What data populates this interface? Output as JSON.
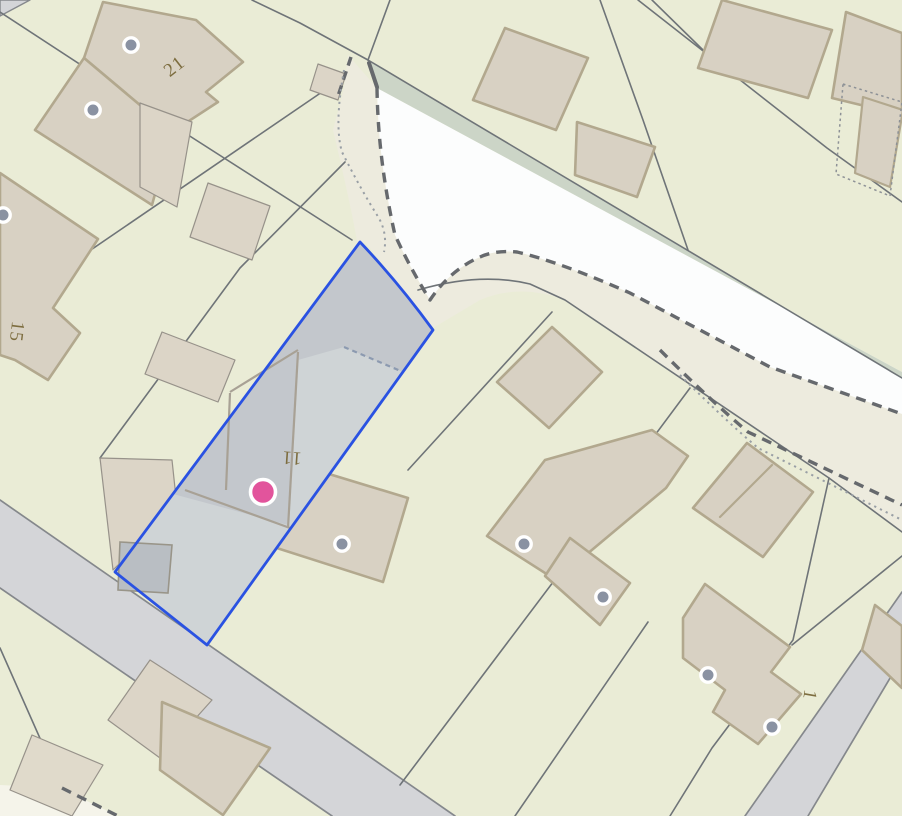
{
  "map": {
    "canvas": {
      "width": 902,
      "height": 816,
      "background": "#eaecd6"
    },
    "palette": {
      "parcel_bg": "#eaecd6",
      "boundary_line": "#6f7478",
      "building_fill": "#d8d1c3",
      "building_border": "#b2a88e",
      "building_thin_border": "#97928a",
      "building_light_fill": "#dcd5c7",
      "road_fill": "#d4d5d8",
      "road_edge": "#85888c",
      "track_white": "#fcfdfd",
      "track_margin": "#edebde",
      "verge_green": "#ccd5c7",
      "bold_dash": "#66696d",
      "fine_dot": "#999fa5",
      "selected_outline": "#2a52e2",
      "selected_fill_light": "#cfd4d6",
      "selected_fill_dark": "#c3c7cc",
      "selected_outbuilding": "#b9bec3",
      "selected_inner_line": "#a8a195",
      "selected_inner_dash": "#8c9ab0",
      "address_dot": "#8a92a2",
      "marker_pink": "#e2549c",
      "label_color": "#7d6d3f"
    },
    "shapes": [
      {
        "name": "road-corner-top-left",
        "kind": "polygon",
        "points": "0,0 30,0 0,16",
        "fill": "#d4d5d8",
        "stroke": "#85888c",
        "width": 1.4
      },
      {
        "name": "track-margin",
        "kind": "path",
        "d": "M348,55 L377,88 Q378,160 395,235 Q410,268 430,300 Q450,270 480,257 Q495,250 517,252 Q560,262 630,293 L770,367 L902,414 L902,532 L830,478 L565,300 Q520,283 480,300 L433,328 L365,242 L358,247 Q352,210 333,130 L344,88 Z",
        "fill": "#edebde"
      },
      {
        "name": "track-white-surface",
        "kind": "path",
        "d": "M377,88 L902,372 L902,414 L770,367 L630,293 Q560,262 517,252 Q495,250 480,257 Q450,270 430,300 Q410,268 395,235 Q378,160 377,88 Z",
        "fill": "#fcfdfd"
      },
      {
        "name": "roadside-verge",
        "kind": "path",
        "d": "M368,60 L902,378 L902,372 L377,88 Z",
        "fill": "#ccd5c7"
      },
      {
        "name": "verge-end-cap",
        "kind": "line",
        "x1": 369,
        "y1": 63,
        "x2": 377,
        "y2": 87,
        "stroke": "#66696d",
        "width": 4
      },
      {
        "name": "road-bottom-left",
        "kind": "polygon",
        "points": "0,500 455,816 332,816 0,588",
        "fill": "#d4d5d8"
      },
      {
        "name": "road-bottom-left-edge-ne",
        "kind": "line",
        "x1": 0,
        "y1": 500,
        "x2": 455,
        "y2": 816,
        "stroke": "#85888c",
        "width": 1.7
      },
      {
        "name": "road-bottom-left-edge-sw",
        "kind": "line",
        "x1": 0,
        "y1": 588,
        "x2": 332,
        "y2": 816,
        "stroke": "#85888c",
        "width": 1.7
      },
      {
        "name": "road-bottom-right",
        "kind": "polygon",
        "points": "902,592 902,658 808,816 745,816",
        "fill": "#d4d5d8"
      },
      {
        "name": "road-bottom-right-edge-ne",
        "kind": "line",
        "x1": 902,
        "y1": 592,
        "x2": 745,
        "y2": 816,
        "stroke": "#85888c",
        "width": 1.7
      },
      {
        "name": "road-bottom-right-edge-sw",
        "kind": "line",
        "x1": 902,
        "y1": 658,
        "x2": 808,
        "y2": 816,
        "stroke": "#85888c",
        "width": 1.7
      },
      {
        "name": "footpath-patch-bottom-left",
        "kind": "polygon",
        "points": "0,785 60,788 118,816 0,816",
        "fill": "#f5f4ea"
      },
      {
        "name": "parcel-line",
        "kind": "path",
        "d": "M0,12 L185,133 L352,240",
        "stroke": "#6f7478",
        "width": 1.6
      },
      {
        "name": "parcel-line",
        "kind": "path",
        "d": "M252,0 L300,23 L368,60",
        "stroke": "#6f7478",
        "width": 1.6
      },
      {
        "name": "parcel-line",
        "kind": "path",
        "d": "M390,0 L368,60",
        "stroke": "#6f7478",
        "width": 1.6
      },
      {
        "name": "parcel-line",
        "kind": "path",
        "d": "M368,60 L902,378",
        "stroke": "#6f7478",
        "width": 1.6
      },
      {
        "name": "parcel-line",
        "kind": "path",
        "d": "M418,290 Q480,272 530,284 L565,300 L829,478 L902,532",
        "stroke": "#6f7478",
        "width": 1.6
      },
      {
        "name": "parcel-line",
        "kind": "path",
        "d": "M322,92 L0,312",
        "stroke": "#6f7478",
        "width": 1.6
      },
      {
        "name": "parcel-line",
        "kind": "path",
        "d": "M345,162 L240,268 L100,458",
        "stroke": "#6f7478",
        "width": 1.6
      },
      {
        "name": "parcel-line",
        "kind": "path",
        "d": "M600,0 L643,120 L688,250",
        "stroke": "#6f7478",
        "width": 1.6
      },
      {
        "name": "parcel-line",
        "kind": "path",
        "d": "M638,0 L827,148 L902,202",
        "stroke": "#6f7478",
        "width": 1.6
      },
      {
        "name": "parcel-line",
        "kind": "path",
        "d": "M652,0 L703,50",
        "stroke": "#6f7478",
        "width": 1.6
      },
      {
        "name": "parcel-line",
        "kind": "path",
        "d": "M552,312 L408,470",
        "stroke": "#6f7478",
        "width": 1.6
      },
      {
        "name": "parcel-line",
        "kind": "path",
        "d": "M690,388 L603,505",
        "stroke": "#6f7478",
        "width": 1.6
      },
      {
        "name": "parcel-line",
        "kind": "path",
        "d": "M829,478 L793,640 L712,748 L670,816",
        "stroke": "#6f7478",
        "width": 1.6
      },
      {
        "name": "parcel-line",
        "kind": "path",
        "d": "M792,645 L902,556",
        "stroke": "#6f7478",
        "width": 1.6
      },
      {
        "name": "parcel-line",
        "kind": "path",
        "d": "M615,500 L400,785",
        "stroke": "#6f7478",
        "width": 1.6
      },
      {
        "name": "parcel-line",
        "kind": "path",
        "d": "M648,622 L515,816",
        "stroke": "#6f7478",
        "width": 1.6
      },
      {
        "name": "parcel-line",
        "kind": "path",
        "d": "M0,648 L62,788",
        "stroke": "#6f7478",
        "width": 1.6
      },
      {
        "name": "building",
        "kind": "polygon",
        "points": "103,2 196,20 243,62 206,92 218,102 172,132 84,58",
        "fill": "#d8d1c3",
        "stroke": "#b2a88e",
        "width": 2.6
      },
      {
        "name": "building",
        "kind": "polygon",
        "points": "84,58 172,132 152,205 35,130",
        "fill": "#d8d1c3",
        "stroke": "#b2a88e",
        "width": 2.6
      },
      {
        "name": "building",
        "kind": "polygon",
        "points": "0,173 98,239 53,308 80,333 48,380 15,360 0,355",
        "fill": "#d8d1c3",
        "stroke": "#b2a88e",
        "width": 2.6
      },
      {
        "name": "building",
        "kind": "polygon",
        "points": "140,103 192,122 177,207 140,187",
        "fill": "#dcd5c7",
        "stroke": "#97928a",
        "width": 1.2
      },
      {
        "name": "building",
        "kind": "polygon",
        "points": "208,183 270,206 252,260 190,237",
        "fill": "#dcd5c7",
        "stroke": "#97928a",
        "width": 1.2
      },
      {
        "name": "building",
        "kind": "polygon",
        "points": "162,332 235,360 218,402 145,374",
        "fill": "#dcd5c7",
        "stroke": "#97928a",
        "width": 1.2
      },
      {
        "name": "building",
        "kind": "polygon",
        "points": "318,64 346,74 338,100 310,90",
        "fill": "#dcd5c7",
        "stroke": "#97928a",
        "width": 1.2
      },
      {
        "name": "building",
        "kind": "polygon",
        "points": "100,458 172,460 177,507 113,570",
        "fill": "#dcd5c7",
        "stroke": "#97928a",
        "width": 1.2
      },
      {
        "name": "building",
        "kind": "polygon",
        "points": "283,460 408,498 383,582 258,542",
        "fill": "#d8d1c3",
        "stroke": "#b2a88e",
        "width": 2.6
      },
      {
        "name": "building",
        "kind": "polygon",
        "points": "505,28 588,58 556,130 473,100",
        "fill": "#d8d1c3",
        "stroke": "#b2a88e",
        "width": 2.6
      },
      {
        "name": "building",
        "kind": "polygon",
        "points": "577,122 655,147 637,197 575,175",
        "fill": "#d8d1c3",
        "stroke": "#b2a88e",
        "width": 2.6
      },
      {
        "name": "building",
        "kind": "polygon",
        "points": "722,0 832,30 808,98 698,68",
        "fill": "#d8d1c3",
        "stroke": "#b2a88e",
        "width": 2.6
      },
      {
        "name": "building",
        "kind": "polygon",
        "points": "846,12 902,33 902,115 832,98",
        "fill": "#d8d1c3",
        "stroke": "#b2a88e",
        "width": 2.6
      },
      {
        "name": "building",
        "kind": "polygon",
        "points": "863,97 903,110 890,187 855,173",
        "fill": "#d8d1c3",
        "stroke": "#b2a88e",
        "width": 2.2
      },
      {
        "name": "building",
        "kind": "polygon",
        "points": "552,327 602,372 549,428 497,382",
        "fill": "#d8d1c3",
        "stroke": "#b2a88e",
        "width": 2.6
      },
      {
        "name": "building",
        "kind": "polygon",
        "points": "487,536 545,460 652,430 688,456 666,488 556,580",
        "fill": "#d8d1c3",
        "stroke": "#b2a88e",
        "width": 2.6
      },
      {
        "name": "building",
        "kind": "polygon",
        "points": "570,538 630,583 600,625 545,576",
        "fill": "#d8d1c3",
        "stroke": "#b2a88e",
        "width": 2.6
      },
      {
        "name": "building",
        "kind": "polygon",
        "points": "683,618 705,584 790,647 771,672 801,694 758,744 713,712 725,690 683,658",
        "fill": "#d8d1c3",
        "stroke": "#b2a88e",
        "width": 2.6
      },
      {
        "name": "building",
        "kind": "polygon",
        "points": "747,443 813,492 763,557 693,508",
        "fill": "#d8d1c3",
        "stroke": "#b2a88e",
        "width": 2.6
      },
      {
        "name": "building-party-wall",
        "kind": "line",
        "x1": 772,
        "y1": 465,
        "x2": 720,
        "y2": 517,
        "stroke": "#b2a88e",
        "width": 2.2
      },
      {
        "name": "building",
        "kind": "polygon",
        "points": "875,605 902,626 902,688 862,650",
        "fill": "#d8d1c3",
        "stroke": "#b2a88e",
        "width": 2.6
      },
      {
        "name": "building",
        "kind": "polygon",
        "points": "150,660 212,700 160,758 108,720",
        "fill": "#dcd5c7",
        "stroke": "#97928a",
        "width": 1.2
      },
      {
        "name": "building",
        "kind": "polygon",
        "points": "162,702 270,748 223,815 160,770",
        "fill": "#d8d1c3",
        "stroke": "#b2a88e",
        "width": 2.6
      },
      {
        "name": "building",
        "kind": "polygon",
        "points": "32,735 103,765 72,816 10,790",
        "fill": "#e0dacb",
        "stroke": "#97928a",
        "width": 1.2
      },
      {
        "name": "track-edge-dashed",
        "kind": "path",
        "d": "M377,88 Q378,160 395,235 Q410,268 430,300 Q450,270 480,257 Q495,250 517,252 Q560,262 630,293 L770,367 L902,414",
        "stroke": "#66696d",
        "width": 3.4,
        "dash": "10 7"
      },
      {
        "name": "track-edge-dashed",
        "kind": "path",
        "d": "M351,57 L338,96",
        "stroke": "#66696d",
        "width": 3.4,
        "dash": "9 6"
      },
      {
        "name": "footpath-dashed",
        "kind": "path",
        "d": "M660,350 Q710,400 748,432 L902,505",
        "stroke": "#66696d",
        "width": 3.4,
        "dash": "10 7"
      },
      {
        "name": "footpath-dashed",
        "kind": "path",
        "d": "M62,788 L118,816",
        "stroke": "#66696d",
        "width": 3.4,
        "dash": "10 7"
      },
      {
        "name": "boundary-dotted",
        "kind": "path",
        "d": "M344,70 Q334,125 342,152 Q360,188 377,215 Q388,232 384,252",
        "stroke": "#999fa5",
        "width": 2,
        "dash": "2.2 4.2"
      },
      {
        "name": "boundary-dotted",
        "kind": "path",
        "d": "M680,375 Q725,420 758,448 L902,520",
        "stroke": "#999fa5",
        "width": 2,
        "dash": "2.2 4.2"
      },
      {
        "name": "boundary-dotted",
        "kind": "polygon",
        "points": "843,84 902,102 890,196 836,174",
        "fill": "none",
        "stroke": "#8d9196",
        "width": 1.5,
        "dash": "2.5 3.2"
      }
    ],
    "selected_parcel": {
      "outline_d": "M360,242 L115,572 L207,645 L433,330 Q398,282 360,242 Z",
      "fill_light": "#cfd4d6",
      "outline_color": "#2a52e2",
      "outline_width": 2.8,
      "dark_area_d": "M360,242 L433,328 L403,372 L344,347 L298,360 L288,525 L173,494 Z",
      "dark_fill": "#c3c7cc",
      "outbuilding_points": "120,542 172,545 168,593 118,590",
      "outbuilding_fill": "#b9bec3",
      "inner_lines": [
        "M185,490 L290,528",
        "M230,393 L226,490",
        "M230,392 L298,350",
        "M298,352 L288,528"
      ],
      "inner_dash_d": "M344,347 L403,372"
    },
    "markers": {
      "address_points": [
        {
          "x": 131,
          "y": 45
        },
        {
          "x": 93,
          "y": 110
        },
        {
          "x": 3,
          "y": 215
        },
        {
          "x": 342,
          "y": 544
        },
        {
          "x": 524,
          "y": 544
        },
        {
          "x": 603,
          "y": 597
        },
        {
          "x": 708,
          "y": 675
        },
        {
          "x": 772,
          "y": 727
        }
      ],
      "address_dot_radius": 7.2,
      "selected_point": {
        "x": 263,
        "y": 492,
        "radius": 12.5,
        "color": "#e2549c"
      }
    },
    "labels": [
      {
        "text": "21",
        "x": 178,
        "y": 71,
        "rotate": -38,
        "size": 19
      },
      {
        "text": "15",
        "x": 11,
        "y": 331,
        "rotate": 97,
        "size": 19
      },
      {
        "text": "11",
        "x": 292,
        "y": 452,
        "rotate": 184,
        "size": 19
      },
      {
        "text": "1",
        "x": 804,
        "y": 694,
        "rotate": 100,
        "size": 19
      }
    ]
  }
}
